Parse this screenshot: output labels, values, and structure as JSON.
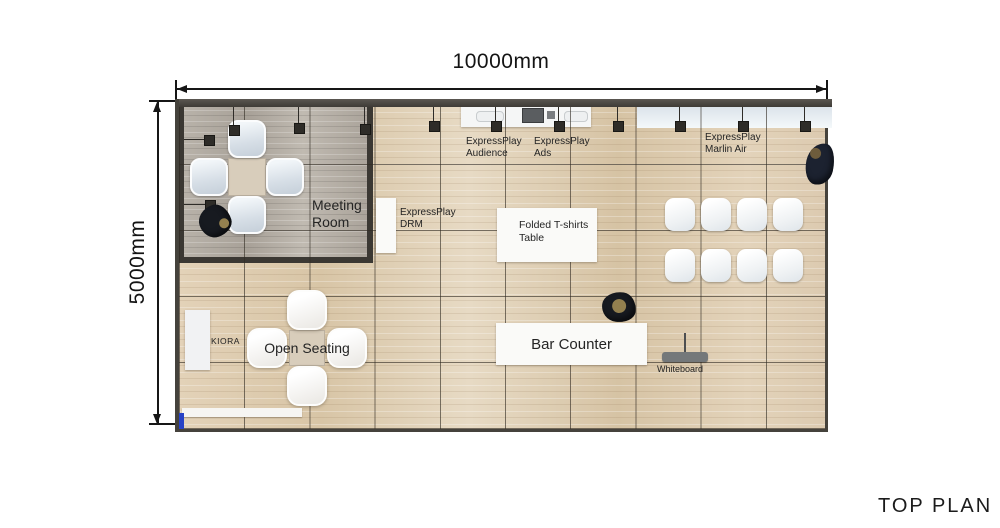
{
  "dims": {
    "horizontal": "10000mm",
    "vertical": "5000mm"
  },
  "title": "TOP PLAN",
  "rooms": {
    "meeting": {
      "line1": "Meeting",
      "line2": "Room"
    },
    "open_seating": "Open Seating",
    "kiora": "KIORA",
    "bar_counter": "Bar Counter",
    "whiteboard": "Whiteboard",
    "tshirt": {
      "line1": "Folded T-shirts",
      "line2": "Table"
    }
  },
  "stations": {
    "audience": {
      "line1": "ExpressPlay",
      "line2": "Audience"
    },
    "ads": {
      "line1": "ExpressPlay",
      "line2": "Ads"
    },
    "marlin": {
      "line1": "ExpressPlay",
      "line2": "Marlin Air"
    },
    "drm": {
      "line1": "ExpressPlay",
      "line2": "DRM"
    }
  },
  "colors": {
    "floor_wood": "#ddcbb0",
    "meeting_room_floor": "#b0a9a0",
    "wall": "#45423c",
    "accent_blue": "#2742c6",
    "chair": "#e9eef3",
    "label_text": "#242424"
  }
}
